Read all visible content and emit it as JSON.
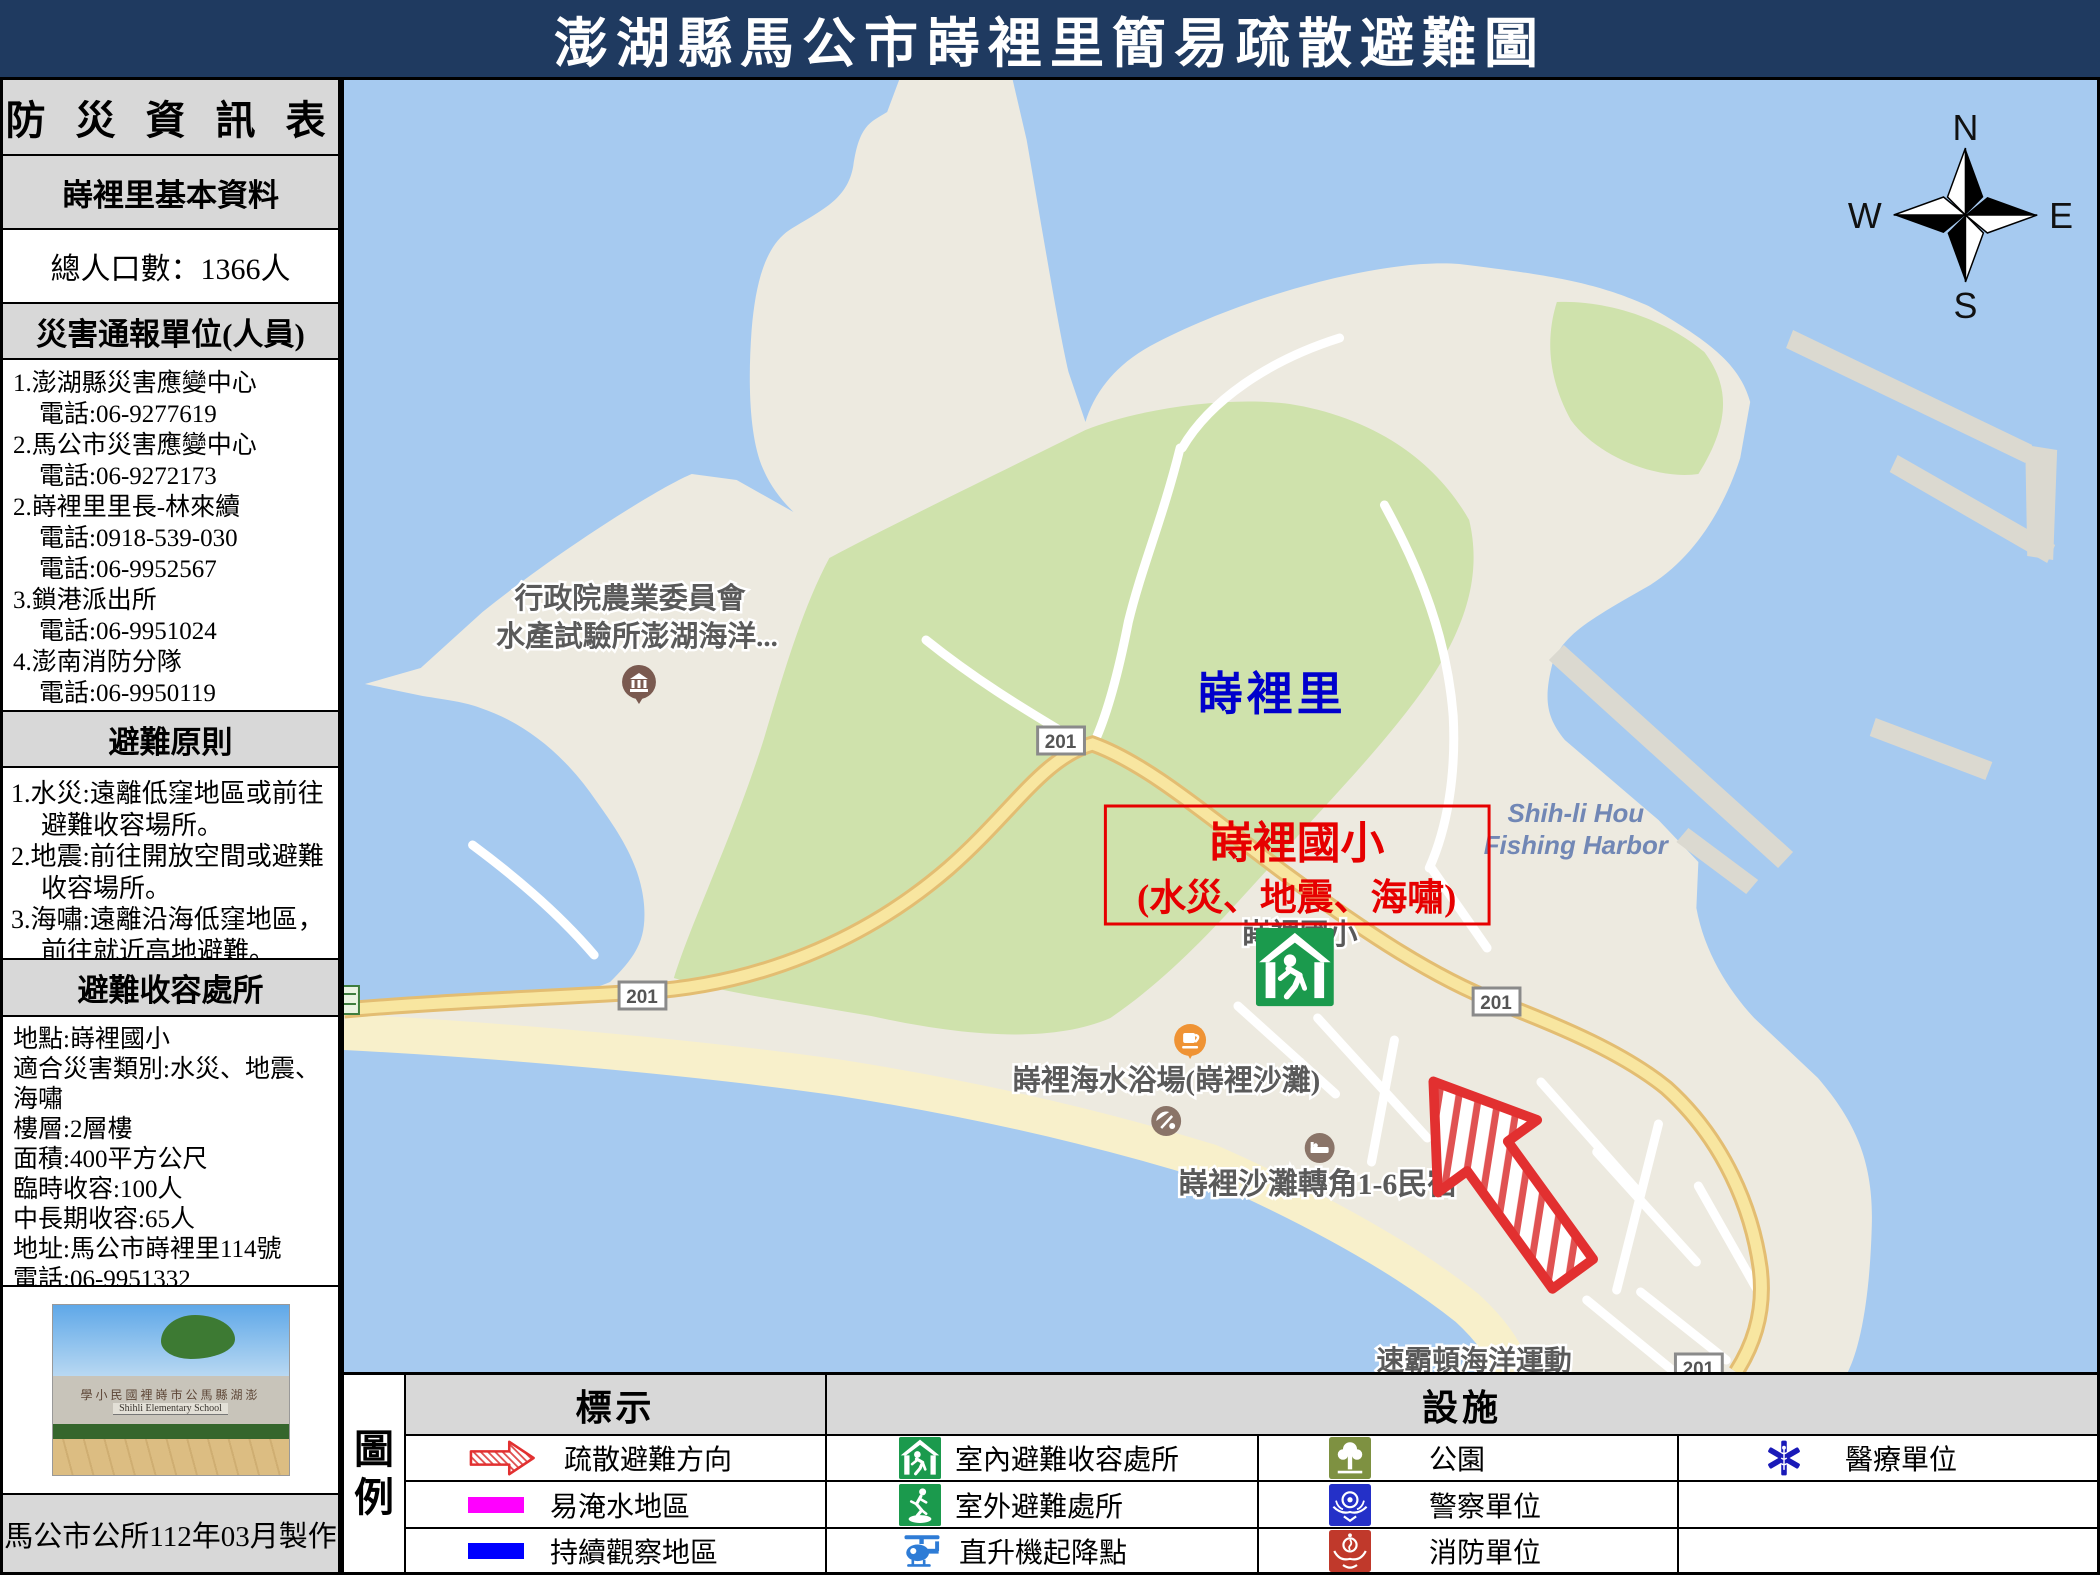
{
  "title": "澎湖縣馬公市嵵裡里簡易疏散避難圖",
  "colors": {
    "header_bg": "#1f3a60",
    "sea": "#a6caf0",
    "land": "#edeae0",
    "greenery": "#cfe2ac",
    "beach": "#f8f0cb",
    "road": "#f8e6a0",
    "accent_red": "#e60000",
    "village_blue": "#0000cc",
    "flood_zone": "#ff00ff",
    "watch_zone": "#0000ff",
    "shelter_green": "#1b9a4d"
  },
  "sidebar": {
    "header": "防 災 資 訊 表",
    "basic_header": "嵵裡里基本資料",
    "population": "總人口數：1366人",
    "notify_header": "災害通報單位(人員)",
    "notify_lines": [
      {
        "t": "1.澎湖縣災害應變中心"
      },
      {
        "t": "電話:06-9277619"
      },
      {
        "t": "2.馬公市災害應變中心"
      },
      {
        "t": "電話:06-9272173"
      },
      {
        "t": "2.嵵裡里里長-林來續"
      },
      {
        "t": "電話:0918-539-030"
      },
      {
        "t": "電話:06-9952567"
      },
      {
        "t": "3.鎖港派出所"
      },
      {
        "t": "電話:06-9951024"
      },
      {
        "t": "4.澎南消防分隊"
      },
      {
        "t": "電話:06-9950119"
      }
    ],
    "principle_header": "避難原則",
    "principles": [
      "1.水災:遠離低窪地區或前往避難收容場所。",
      "2.地震:前往開放空間或避難收容場所。",
      "3.海嘯:遠離沿海低窪地區，前往就近高地避難。"
    ],
    "shelter_header": "避難收容處所",
    "shelter_lines": [
      "地點:嵵裡國小",
      "適合災害類別:水災、地震、海嘯",
      "樓層:2層樓",
      "面積:400平方公尺",
      "臨時收容:100人",
      "中長期收容:65人",
      "地址:馬公市嵵裡里114號",
      "電話:06-9951332"
    ],
    "photo": {
      "school_sign_zh": "學小民國裡嵵市公馬縣湖澎",
      "school_sign_en": "Shihli Elementary School"
    },
    "footer": "馬公市公所112年03月製作"
  },
  "map": {
    "village_label": "嵵裡里",
    "school_box": {
      "line1": "嵵裡國小",
      "line2": "(水災、地震、海嘯)"
    },
    "fisheries_label": {
      "line1": "行政院農業委員會",
      "line2": "水產試驗所澎湖海洋..."
    },
    "harbor_label": {
      "line1": "Shih-li Hou",
      "line2": "Fishing Harbor"
    },
    "school_poi_label": "嵵裡國小",
    "beach_label": "嵵裡海水浴場(嵵裡沙灘)",
    "bnb_label": "嵵裡沙灘轉角1-6民宿",
    "marine_label": "速霸頓海洋運動",
    "road_number": "201",
    "compass": {
      "n": "N",
      "e": "E",
      "s": "S",
      "w": "W"
    }
  },
  "legend": {
    "title_chars": [
      "圖",
      "例"
    ],
    "marks_header": "標示",
    "facilities_header": "設施",
    "marks": [
      "疏散避難方向",
      "易淹水地區",
      "持續觀察地區"
    ],
    "shelter_items": [
      "室內避難收容處所",
      "室外避難處所",
      "直升機起降點"
    ],
    "facility_items": [
      "公園",
      "警察單位",
      "消防單位"
    ],
    "medical_item": "醫療單位"
  }
}
